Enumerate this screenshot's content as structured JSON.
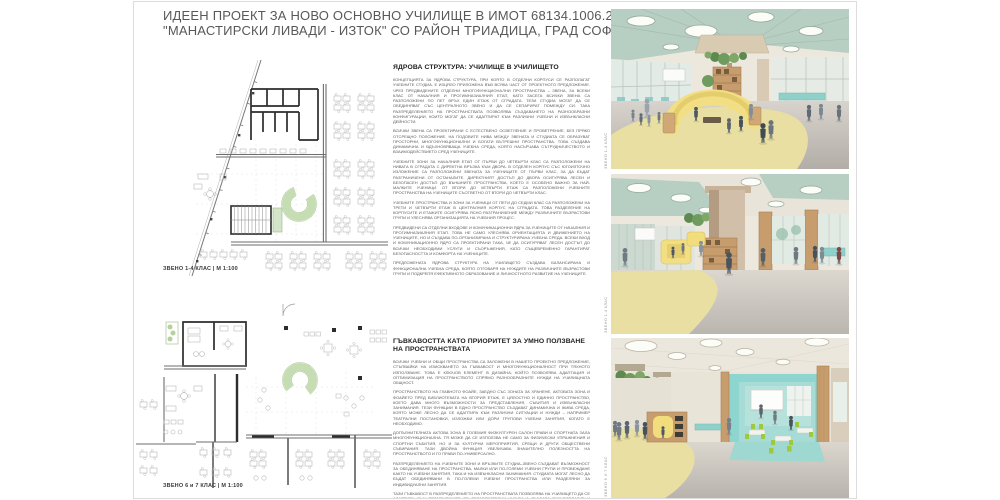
{
  "title": {
    "line1": "ИДЕЕН ПРОЕКТ ЗА НОВО ОСНОВНО УЧИЛИЩЕ В ИМОТ 68134.1006.2626,",
    "line2": "\"МАНАСТИРСКИ ЛИВАДИ - ИЗТОК\"  СО РАЙОН ТРИАДИЦА, ГРАД СОФИЯ"
  },
  "plans": [
    {
      "label": "ЗВЕНО 1-4 КЛАС | М 1:100"
    },
    {
      "label": "ЗВЕНО 6 и 7 КЛАС | М 1:100"
    }
  ],
  "sections": [
    {
      "heading": "ЯДРОВА СТРУКТУРА: УЧИЛИЩЕ В УЧИЛИЩЕТО",
      "paragraphs": [
        "КОНЦЕПЦИЯТА ЗА ЯДРОВА СТРУКТУРА, ПРИ КОЯТО В ОТДЕЛНИ КОРПУСИ СЕ РАЗПОЛАГАТ УЧЕБНИТЕ СТУДИА, Е ИЗЦЯЛО ПРИЛОЖЕНА ВЪВ ВСЯКА ЧАСТ ОТ ПРОЕКТНОТО ПРЕДЛОЖЕНИЕ. ЧРЕЗ ПРЕДВИДЕНИТЕ ОТДЕЛНИ МНОГОФУНКЦИОНАЛНИ ПРОСТРАНСТВА – ЗВЕНА, ЗА ВСЕКИ КЛАС ОТ НАЧАЛНИЯ И ПРОГИМНАЗИАЛНИЯ ЕТАП, КАТО ЗАСЕГА ВСИЧКИ ЗВЕНА СА РАЗПОЛОЖЕНИ ПО ПЕТ ВРЪХ ЕДИН ЕТАЖ ОТ СГРАДАТА. ТЕЗИ СТУДИА МОГАТ ДА СЕ ОБЕДИНЯВАТ СЪС ЦЕНТРАЛНОТО ЗВЕНО И ДА СЕ СЕПАРИРАТ ПОМЕЖДУ СИ. ТАКА РАЗПРЕДЕЛЕНИЕТО НА ПРОСТРАНСТВАТА ПОЗВОЛЯВА СЪЗДАВАНЕТО НА РАЗНООБРАЗНИ КОНФИГУРАЦИИ, КОИТО МОГАТ ДА СЕ АДАПТИРАТ КЪМ РАЗЛИЧНИ УЧЕБНИ И ИЗВЪНКЛАСНИ ДЕЙНОСТИ.",
        "ВСИЧКИ ЗВЕНА СА ПРОЕКТИРАНИ С ЕСТЕСТВЕНО ОСВЕТЛЕНИЕ И ПРОВЕТРЕНИЕ, БЕЗ ПРЯКО ОТСРЕЩНО ПОЛОЖЕНИЕ. НА ПОДОВИТЕ НИВА МЕЖДУ ЗВЕНАТА И СТУДИАТА СЕ ОБРАЗУВАТ ПРОСТОРНИ, МНОГОФУНКЦИОНАЛНИ И БОГАТИ ВЪТРЕШНИ ПРОСТРАНСТВА. ТОВА СЪЗДАВА ДИНАМИЧНА И ВДЪХНОВЯВАЩА УЧЕБНА СРЕДА, КОЯТО НАСЪРЧАВА СЪТРУДНИЧЕСТВОТО И ВЗАИМОДЕЙСТВИЕТО СРЕД УЧЕНИЦИТЕ.",
        "УЧЕБНИТЕ ЗОНИ ЗА НАЧАЛНИЯ ЕТАП ОТ ПЪРВИ ДО ЧЕТВЪРТИ КЛАС СА РАЗПОЛОЖЕНИ НА НИВАТА В СГРАДАТА С ДИРЕКТНА ВРЪЗКА КЪМ ДВОРА. В ОТДЕЛЕН КОРПУС СЪС ЮГОИЗТОЧНО ИЗЛОЖЕНИЕ СА РАЗПОЛОЖЕНИ ЗВЕНАТА ЗА УЧЕНИЦИТЕ ОТ ПЪРВИ КЛАС, ЗА ДА БЪДАТ РАЗГРАНИЧЕНИ ОТ ОСТАНАЛИТЕ. ДИРЕКТНИЯТ ДОСТЪП ДО ДВОРА ОСИГУРЯВА ЛЕСЕН И БЕЗОПАСЕН ДОСТЪП ДО ВЪНШНИТЕ ПРОСТРАНСТВА, КОЕТО Е ОСОБЕНО ВАЖНО ЗА НАЙ-МАЛКИТЕ УЧЕНИЦИ. ОТ ВТОРИ ДО ЧЕТВЪРТИ ЕТАЖ СА РАЗПОЛОЖЕНИ УЧЕБНИТЕ ПРОСТРАНСТВА НА УЧЕНИЦИТЕ СЪОТВЕТНО ОТ ВТОРИ ДО ЧЕТВЪРТИ КЛАС.",
        "УЧЕБНИТЕ ПРОСТРАНСТВА И ЗОНИ ЗА УЧЕНИЦИ ОТ ПЕТИ ДО СЕДМИ КЛАС СА РАЗПОЛОЖЕНИ НА ТРЕТИ И ЧЕТВЪРТИ ЕТАЖ В ЦЕНТРАЛНИЯ КОРПУС НА СГРАДАТА. ТОВА РАЗДЕЛЕНИЕ НА КОРПУСИТЕ И ЕТАЖИТЕ ОСИГУРЯВА ЯСНО РАЗГРАНИЧЕНИЕ МЕЖДУ РАЗЛИЧНИТЕ ВЪЗРАСТОВИ ГРУПИ И УЛЕСНЯВА ОРГАНИЗАЦИЯТА НА УЧЕБНИЯ ПРОЦЕС.",
        "ПРЕДВИДЕНИ СА ОТДЕЛНИ ВХОДОВЕ И КОМУНИКАЦИОННИ ЯДРА ЗА УЧЕНИЦИТЕ ОТ НАЧАЛНИЯ И ПРОГИМНАЗИАЛНИЯ ЕТАП. ТОВА НЕ САМО УЛЕСНЯВА ОРИЕНТАЦИЯТА И ДВИЖЕНИЕТО НА УЧЕНИЦИТЕ, НО И СЪЗДАВА ПО-ОРГАНИЗИРАНА И СТРУКТУРИРАНА УЧЕБНА СРЕДА. ВСЕКИ ВХОД И КОМУНИКАЦИОННО ЯДРО СА ПРОЕКТИРАНИ ТАКА, ЧЕ ДА ОСИГУРЯВАТ ЛЕСЕН ДОСТЪП ДО ВСИЧКИ НЕОБХОДИМИ УСЛУГИ И СЪОРЪЖЕНИЯ, КАТО СЪЩЕВРЕМЕННО ГАРАНТИРАТ БЕЗОПАСНОСТТА И КОМФОРТА НА УЧЕНИЦИТЕ.",
        "ПРЕДЛОЖЕНАТА ЯДРОВА СТРУКТУРА НА УЧИЛИЩЕТО СЪЗДАВА БАЛАНСИРАНА И ФУНКЦИОНАЛНА УЧЕБНА СРЕДА, КОЯТО ОТГОВАРЯ НА НУЖДИТЕ НА РАЗЛИЧНИТЕ ВЪЗРАСТОВИ ГРУПИ И ПОДКРЕПЯ ЕФЕКТИВНОТО ОБРАЗОВАНИЕ И ЛИЧНОСТНОТО РАЗВИТИЕ НА УЧЕНИЦИТЕ."
      ]
    },
    {
      "heading": "ГЪВКАВОСТТА КАТО ПРИОРИТЕТ ЗА УМНО ПОЛЗВАНЕ НА ПРОСТРАНСТВАТА",
      "paragraphs": [
        "ВСИЧКИ УЧЕБНИ И ОБЩИ ПРОСТРАНСТВА СА ЗАЛОЖЕНИ В НАШЕТО ПРОЕКТНО ПРЕДЛОЖЕНИЕ, СТЪПВАЙКИ НА ИЗИСКВАНЕТО ЗА ГЪВКАВОСТ И МНОГОФУНКЦИОНАЛНОСТ ПРИ ТЯХНОТО ИЗПОЛЗВАНЕ. ТОВА Е КЛЮЧОВ ЕЛЕМЕНТ В ДИЗАЙНА, КОЙТО ПОЗВОЛЯВА АДАПТАЦИЯ И ОПТИМИЗАЦИЯ НА ПРОСТРАНСТВОТО СПРЯМО РАЗНООБРАЗНИТЕ НУЖДИ НА УЧИЛИЩНАТА ОБЩНОСТ.",
        "ПРОСТРАНСТВОТО НА ГЛАВНОТО ФОАЙЕ, ЗАЕДНО СЪС ЗОНАТА ЗА ХРАНЕНЕ, АКТОВАТА ЗОНА И ФОАЙЕТО ПРЕД БИБЛИОТЕКАТА НА ВТОРИЯ ЕТАЖ, Е ЦЯЛОСТНО И ЕДИННО ПРОСТРАНСТВО, КОЕТО ДАВА МНОГО ВЪЗМОЖНОСТИ ЗА ПРЕДСТАВЛЕНИЯ, СЪБИТИЯ И ИЗВЪНКЛАСНИ ЗАНИМАНИЯ. ТЕЗИ ФУНКЦИИ В ЕДНО ПРОСТРАНСТВО СЪЗДАВАТ ДИНАМИЧНА И ЖИВА СРЕДА, КОЯТО МОЖЕ ЛЕСНО ДА СЕ АДАПТИРА КЪМ РАЗЛИЧНИ СИТУАЦИИ И НУЖДИ – НАПРИМЕР ТЕАТРАЛНИ ПОСТАНОВКИ, ИЗЛОЖБИ ИЛИ ДОРИ ГРУПОВИ УЧЕБНИ ЗАНЯТИЯ, КОГАТО Е НЕОБХОДИМО.",
        "ДОПЪЛНИТЕЛНАТА АКТОВА ЗОНА В ГОЛЕМИЯ ФИЗКУЛТУРЕН САЛОН ПРАВИ И СПОРТНАТА ЗАЛА МНОГОФУНКЦИОНАЛНА. ТЯ МОЖЕ ДА СЕ ИЗПОЛЗВА НЕ САМО ЗА ФИЗИЧЕСКИ УПРАЖНЕНИЯ И СПОРТНИ СЪБИТИЯ, НО И ЗА КУЛТУРНИ МЕРОПРИЯТИЯ, СРЕЩИ И ДРУГИ ОБЩЕСТВЕНИ СЪБИРАНИЯ. ТАЗИ ДВОЙНА ФУНКЦИЯ УВЕЛИЧАВА ЗНАЧИТЕЛНО ПОЛЕЗНОСТТА НА ПРОСТРАНСТВОТО И ГО ПРАВИ ПО-УНИВЕРСАЛНО.",
        "РАЗПРЕДЕЛЕНИЕТО НА УЧЕБНИТЕ ЗОНИ И ВРЪЗКИТЕ СТУДИА–ЗВЕНО СЪЗДАВАТ ВЪЗМОЖНОСТ ЗА ОБЕДИНЯВАНЕ НА ПРОСТРАНСТВА, МАЛКИ ИЛИ ПО-ГОЛЕМИ УЧЕБНИ ГРУПИ И ПРОВЕЖДАНЕ КАКТО НА УЧЕБНИ ЗАНЯТИЯ, ТАКА И НА ИЗВЪНКЛАСНИ ЗАНИМАНИЯ. СТУДИАТА МОГАТ ЛЕСНО ДА БЪДАТ ОБЕДИНЯВАНИ В ПО-ГОЛЕМИ УЧЕБНИ ПРОСТРАНСТВА ИЛИ РАЗДЕЛЯНИ ЗА ИНДИВИДУАЛНИ ЗАНЯТИЯ.",
        "ТАЗИ ГЪВКАВОСТ В РАЗПРЕДЕЛЕНИЕТО НА ПРОСТРАНСТВАТА ПОЗВОЛЯВА НА УЧИЛИЩЕТО ДА СЕ АДАПТИРА КЪМ ПРОМЕНЯЩИТЕ СЕ ОБРАЗОВАТЕЛНИ НУЖДИ И СЪЗДАВА РАЗНООБРАЗИЕ И ИНТЕРЕС В ЕЖЕДНЕВИЕТО НА УЧЕНИЦИТЕ."
      ]
    }
  ],
  "renders": [
    {
      "caption": "ЗВЕНО 1-4 КЛАС"
    },
    {
      "caption": "ЗВЕНО 1-4 КЛАС"
    },
    {
      "caption": "ЗВЕНО 6 И 7 КЛАС"
    }
  ],
  "colors": {
    "ceiling_mint": "#b7cec3",
    "sofa_yellow": "#f2df83",
    "floor_yellow": "#e9dfa2",
    "teal_wall": "#8ed4cf",
    "chair_green": "#9ec93f",
    "wood": "#c79d6e",
    "plan_green": "#c6dcb2",
    "title_gray": "#57585a"
  }
}
